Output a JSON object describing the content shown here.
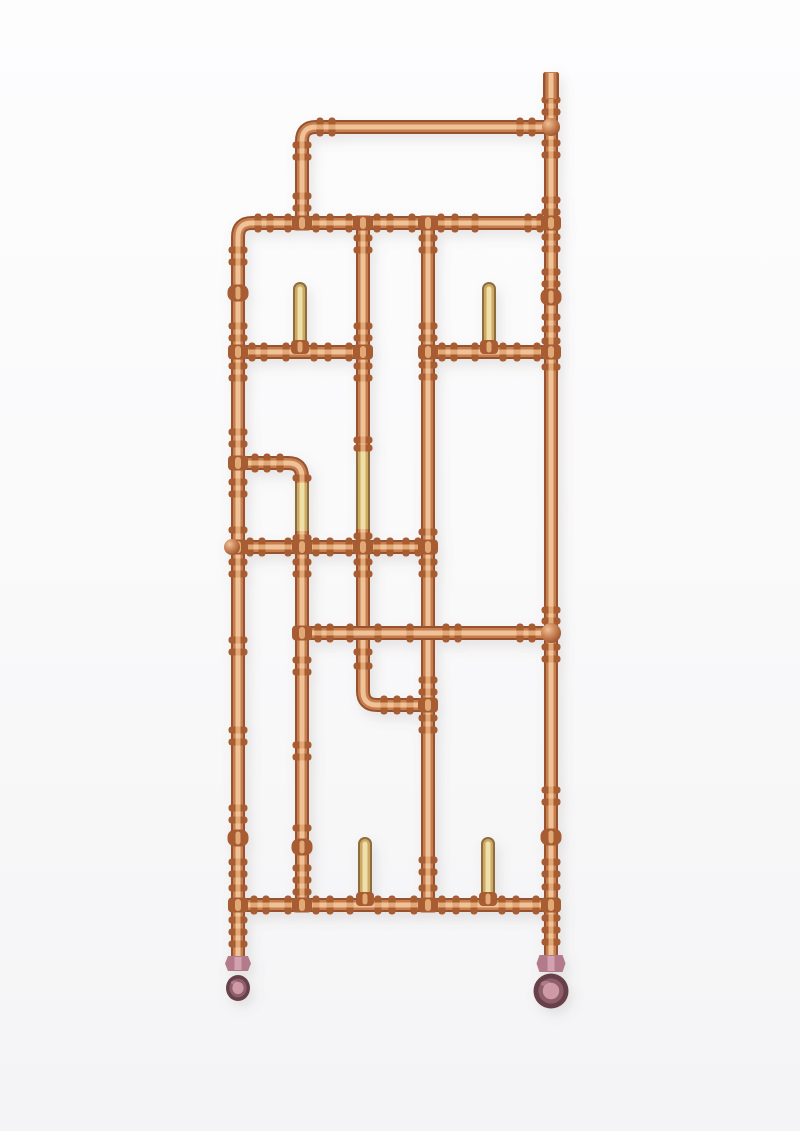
{
  "figure": {
    "kind": "product-photo",
    "subject": "copper-pipework-radiator-sculpture",
    "canvas": {
      "width": 800,
      "height": 1131
    },
    "background": {
      "top": "#fdfdfe",
      "mid": "#f9f9fa",
      "bottom": "#f4f4f6"
    },
    "palette": {
      "copper": {
        "edge": "#98532e",
        "mid": "#c67e51",
        "hi": "#f0c297",
        "fit": "#a75c33",
        "fit_hi": "#e2a977"
      },
      "brass": {
        "edge": "#8d6d3c",
        "mid": "#cda964",
        "hi": "#efdfa9"
      },
      "valve": {
        "body": "#b27a8a",
        "body_hi": "#d2a2b0",
        "wheel_dark": "#684049",
        "wheel_mid": "#8d5f6a",
        "wheel_center": "#cf9aa6"
      },
      "shadow": "#7d6a5d"
    },
    "pipes": [
      {
        "name": "left-frame-pipe",
        "material": "copper",
        "d": "M 551 223 L 252 223 Q 238 223 238 237 L 238 958"
      },
      {
        "name": "right-main-pipe",
        "material": "copper",
        "d": "M 551 97 L 551 958"
      },
      {
        "name": "top-bar-pipe",
        "material": "copper",
        "d": "M 551 127 L 316 127 Q 302 127 302 141 L 302 223"
      },
      {
        "name": "column-c-upper",
        "material": "copper",
        "d": "M 363 223 L 363 453"
      },
      {
        "name": "column-c-brass",
        "material": "brass",
        "d": "M 363 450 L 363 532"
      },
      {
        "name": "column-c-lower-jog",
        "material": "copper",
        "d": "M 363 529 L 363 691 Q 363 705 377 705 L 428 705"
      },
      {
        "name": "column-d",
        "material": "copper",
        "d": "M 428 223 L 428 905"
      },
      {
        "name": "mid-elbow-arm",
        "material": "copper",
        "d": "M 238 463 L 288 463 Q 302 463 302 477 L 302 486"
      },
      {
        "name": "column-b-brass",
        "material": "brass",
        "d": "M 302 483 L 302 534"
      },
      {
        "name": "column-b-lower",
        "material": "copper",
        "d": "M 302 531 L 302 905"
      },
      {
        "name": "rail-3-left",
        "material": "copper",
        "d": "M 238 352 L 363 352"
      },
      {
        "name": "rail-3-right",
        "material": "copper",
        "d": "M 428 352 L 551 352"
      },
      {
        "name": "rail-5",
        "material": "copper",
        "d": "M 231 547 L 428 547"
      },
      {
        "name": "rail-6",
        "material": "copper",
        "d": "M 302 633 L 553 633"
      },
      {
        "name": "rail-8-bottom",
        "material": "copper",
        "d": "M 238 905 L 551 905"
      },
      {
        "name": "hook-peg-top-left",
        "material": "brass",
        "cap": "round",
        "d": "M 300 289 L 300 344"
      },
      {
        "name": "hook-peg-top-right",
        "material": "brass",
        "cap": "round",
        "d": "M 489 289 L 489 344"
      },
      {
        "name": "hook-peg-bottom-left",
        "material": "brass",
        "cap": "round",
        "d": "M 365 844 L 365 897"
      },
      {
        "name": "hook-peg-bottom-right",
        "material": "brass",
        "cap": "round",
        "d": "M 488 844 L 488 897"
      }
    ],
    "beads_v": [
      [
        551,
        100
      ],
      [
        551,
        112
      ],
      [
        551,
        143
      ],
      [
        551,
        155
      ],
      [
        551,
        200
      ],
      [
        551,
        212
      ],
      [
        551,
        237
      ],
      [
        551,
        249
      ],
      [
        551,
        272
      ],
      [
        551,
        284
      ],
      [
        551,
        317
      ],
      [
        551,
        329
      ],
      [
        551,
        341
      ],
      [
        551,
        367
      ],
      [
        551,
        610
      ],
      [
        551,
        621
      ],
      [
        551,
        647
      ],
      [
        551,
        659
      ],
      [
        551,
        790
      ],
      [
        551,
        802
      ],
      [
        551,
        862
      ],
      [
        551,
        874
      ],
      [
        551,
        887
      ],
      [
        551,
        918
      ],
      [
        551,
        930
      ],
      [
        551,
        942
      ],
      [
        238,
        250
      ],
      [
        238,
        262
      ],
      [
        238,
        326
      ],
      [
        238,
        338
      ],
      [
        238,
        366
      ],
      [
        238,
        378
      ],
      [
        238,
        432
      ],
      [
        238,
        444
      ],
      [
        238,
        482
      ],
      [
        238,
        494
      ],
      [
        238,
        530
      ],
      [
        238,
        562
      ],
      [
        238,
        574
      ],
      [
        238,
        640
      ],
      [
        238,
        652
      ],
      [
        238,
        730
      ],
      [
        238,
        742
      ],
      [
        238,
        808
      ],
      [
        238,
        820
      ],
      [
        238,
        862
      ],
      [
        238,
        874
      ],
      [
        238,
        888
      ],
      [
        238,
        920
      ],
      [
        238,
        932
      ],
      [
        238,
        944
      ],
      [
        302,
        145
      ],
      [
        302,
        157
      ],
      [
        302,
        196
      ],
      [
        302,
        208
      ],
      [
        302,
        478
      ],
      [
        302,
        538
      ],
      [
        302,
        562
      ],
      [
        302,
        574
      ],
      [
        302,
        660
      ],
      [
        302,
        672
      ],
      [
        302,
        745
      ],
      [
        302,
        757
      ],
      [
        302,
        828
      ],
      [
        302,
        868
      ],
      [
        302,
        880
      ],
      [
        302,
        892
      ],
      [
        363,
        238
      ],
      [
        363,
        250
      ],
      [
        363,
        326
      ],
      [
        363,
        338
      ],
      [
        363,
        366
      ],
      [
        363,
        378
      ],
      [
        363,
        440
      ],
      [
        363,
        448
      ],
      [
        363,
        536
      ],
      [
        363,
        562
      ],
      [
        363,
        574
      ],
      [
        363,
        652
      ],
      [
        363,
        666
      ],
      [
        428,
        238
      ],
      [
        428,
        250
      ],
      [
        428,
        326
      ],
      [
        428,
        338
      ],
      [
        428,
        365
      ],
      [
        428,
        377
      ],
      [
        428,
        532
      ],
      [
        428,
        562
      ],
      [
        428,
        574
      ],
      [
        428,
        680
      ],
      [
        428,
        692
      ],
      [
        428,
        718
      ],
      [
        428,
        730
      ],
      [
        428,
        860
      ],
      [
        428,
        872
      ],
      [
        428,
        888
      ]
    ],
    "beads_h": [
      [
        320,
        127
      ],
      [
        332,
        127
      ],
      [
        520,
        127
      ],
      [
        532,
        127
      ],
      [
        258,
        223
      ],
      [
        270,
        223
      ],
      [
        288,
        223
      ],
      [
        316,
        223
      ],
      [
        330,
        223
      ],
      [
        349,
        223
      ],
      [
        377,
        223
      ],
      [
        390,
        223
      ],
      [
        412,
        223
      ],
      [
        441,
        223
      ],
      [
        455,
        223
      ],
      [
        475,
        223
      ],
      [
        528,
        223
      ],
      [
        540,
        223
      ],
      [
        252,
        352
      ],
      [
        264,
        352
      ],
      [
        286,
        352
      ],
      [
        314,
        352
      ],
      [
        328,
        352
      ],
      [
        349,
        352
      ],
      [
        442,
        352
      ],
      [
        454,
        352
      ],
      [
        475,
        352
      ],
      [
        503,
        352
      ],
      [
        517,
        352
      ],
      [
        537,
        352
      ],
      [
        255,
        463
      ],
      [
        267,
        463
      ],
      [
        280,
        463
      ],
      [
        250,
        547
      ],
      [
        262,
        547
      ],
      [
        288,
        547
      ],
      [
        316,
        547
      ],
      [
        330,
        547
      ],
      [
        349,
        547
      ],
      [
        377,
        547
      ],
      [
        390,
        547
      ],
      [
        406,
        547
      ],
      [
        418,
        547
      ],
      [
        318,
        633
      ],
      [
        330,
        633
      ],
      [
        350,
        633
      ],
      [
        378,
        633
      ],
      [
        410,
        633
      ],
      [
        446,
        633
      ],
      [
        458,
        633
      ],
      [
        520,
        633
      ],
      [
        532,
        633
      ],
      [
        384,
        705
      ],
      [
        397,
        705
      ],
      [
        410,
        705
      ],
      [
        254,
        905
      ],
      [
        266,
        905
      ],
      [
        288,
        905
      ],
      [
        316,
        905
      ],
      [
        330,
        905
      ],
      [
        350,
        905
      ],
      [
        378,
        905
      ],
      [
        392,
        905
      ],
      [
        414,
        905
      ],
      [
        442,
        905
      ],
      [
        456,
        905
      ],
      [
        474,
        905
      ],
      [
        502,
        905
      ],
      [
        516,
        905
      ],
      [
        536,
        905
      ]
    ],
    "sockets": [
      [
        302,
        223
      ],
      [
        363,
        223
      ],
      [
        428,
        223
      ],
      [
        551,
        223
      ],
      [
        238,
        352
      ],
      [
        363,
        352
      ],
      [
        428,
        352
      ],
      [
        551,
        352
      ],
      [
        238,
        463
      ],
      [
        238,
        547
      ],
      [
        302,
        547
      ],
      [
        363,
        547
      ],
      [
        428,
        547
      ],
      [
        302,
        633
      ],
      [
        428,
        705
      ],
      [
        238,
        905
      ],
      [
        302,
        905
      ],
      [
        428,
        905
      ],
      [
        551,
        905
      ]
    ],
    "peg_sockets": [
      [
        300,
        347
      ],
      [
        489,
        347
      ],
      [
        365,
        899
      ],
      [
        488,
        899
      ]
    ],
    "mounts": [
      {
        "x": 238,
        "y": 293
      },
      {
        "x": 551,
        "y": 297
      },
      {
        "x": 238,
        "y": 838
      },
      {
        "x": 551,
        "y": 837
      },
      {
        "x": 302,
        "y": 847
      }
    ],
    "balls": [
      {
        "cx": 551,
        "cy": 127,
        "r": 9
      },
      {
        "cx": 551,
        "cy": 633,
        "r": 10
      },
      {
        "cx": 232,
        "cy": 547,
        "r": 8
      }
    ],
    "end_cap": {
      "x": 551,
      "y_top": 72,
      "w": 16,
      "h": 27
    },
    "valves": [
      {
        "name": "left-valve",
        "view": "side",
        "nut": {
          "x": 238,
          "y": 956,
          "w": 26,
          "h": 15
        },
        "wheel": {
          "cx": 238,
          "cy": 988,
          "rx": 12,
          "ry": 13
        }
      },
      {
        "name": "right-valve",
        "view": "front",
        "nut": {
          "x": 551,
          "y": 955,
          "w": 29,
          "h": 17
        },
        "wheel": {
          "cx": 551,
          "cy": 991,
          "rx": 17.5,
          "ry": 17.5
        }
      }
    ]
  }
}
